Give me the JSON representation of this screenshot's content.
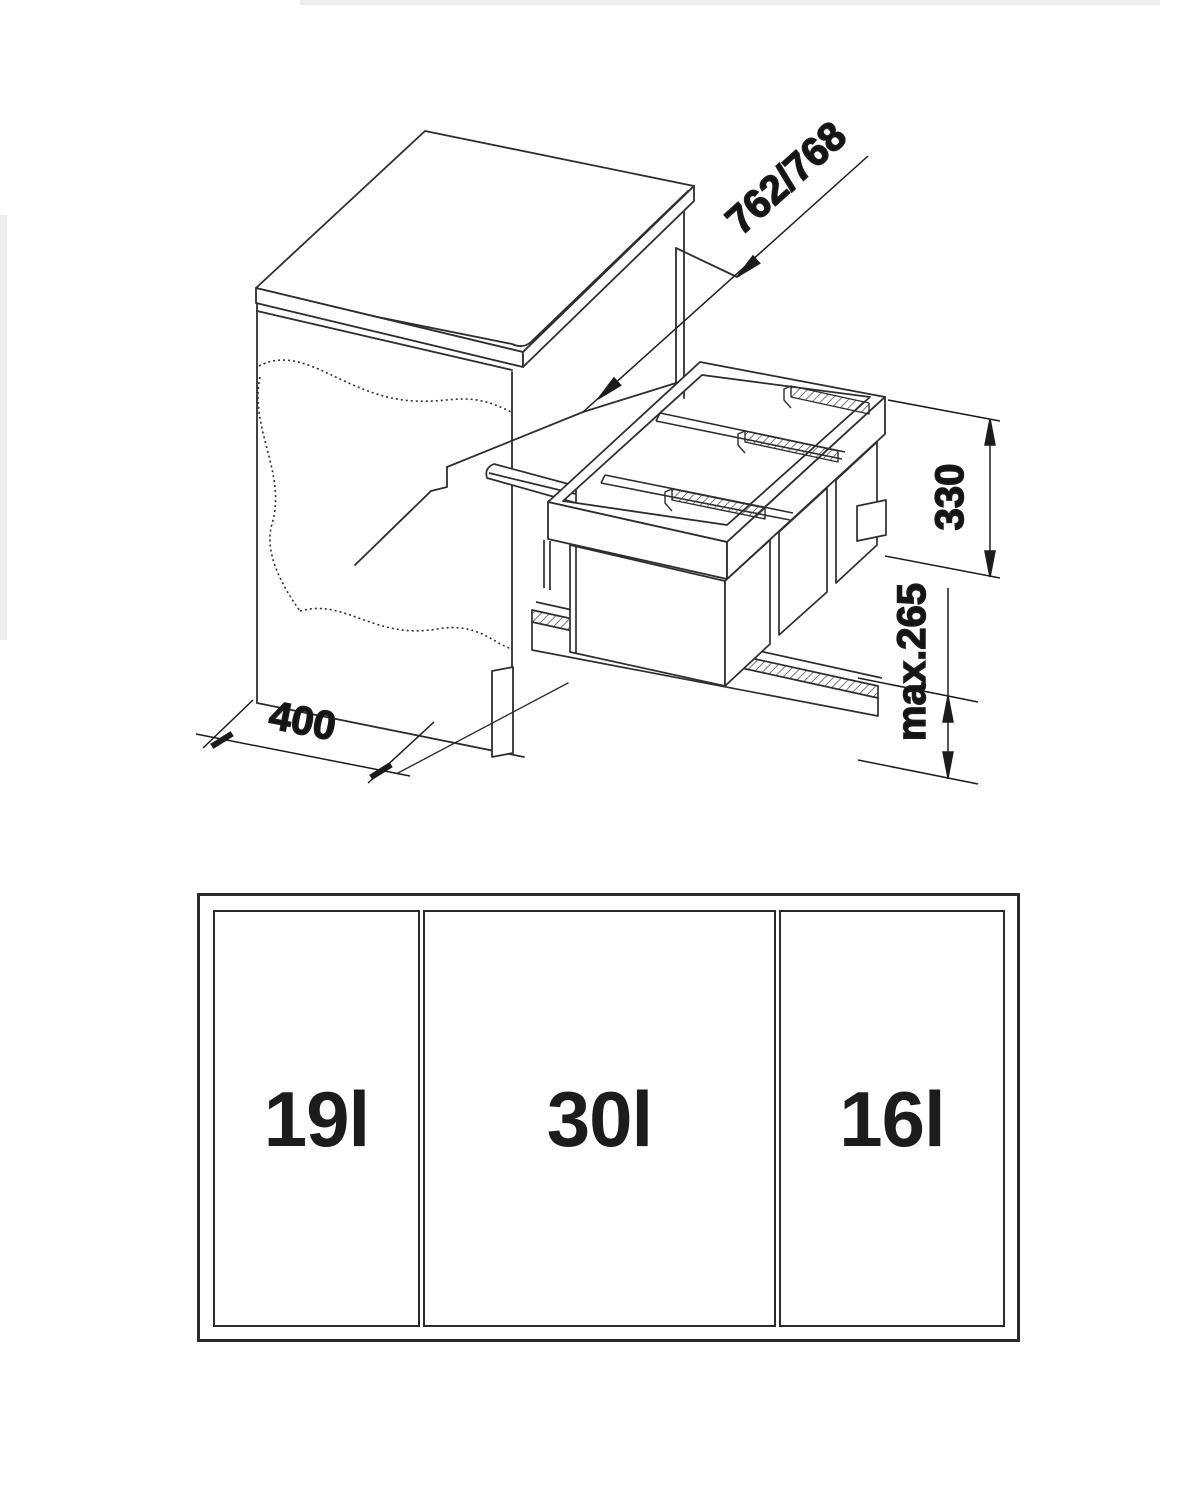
{
  "drawing": {
    "dims": {
      "depth_label": "762/768",
      "height_label": "330",
      "max_label": "max.265",
      "width_label": "400"
    },
    "colors": {
      "line": "#2e2e2e",
      "text": "#141414",
      "background": "#ffffff"
    }
  },
  "plan": {
    "cells": [
      {
        "label": "19l"
      },
      {
        "label": "30l"
      },
      {
        "label": "16l"
      }
    ]
  }
}
